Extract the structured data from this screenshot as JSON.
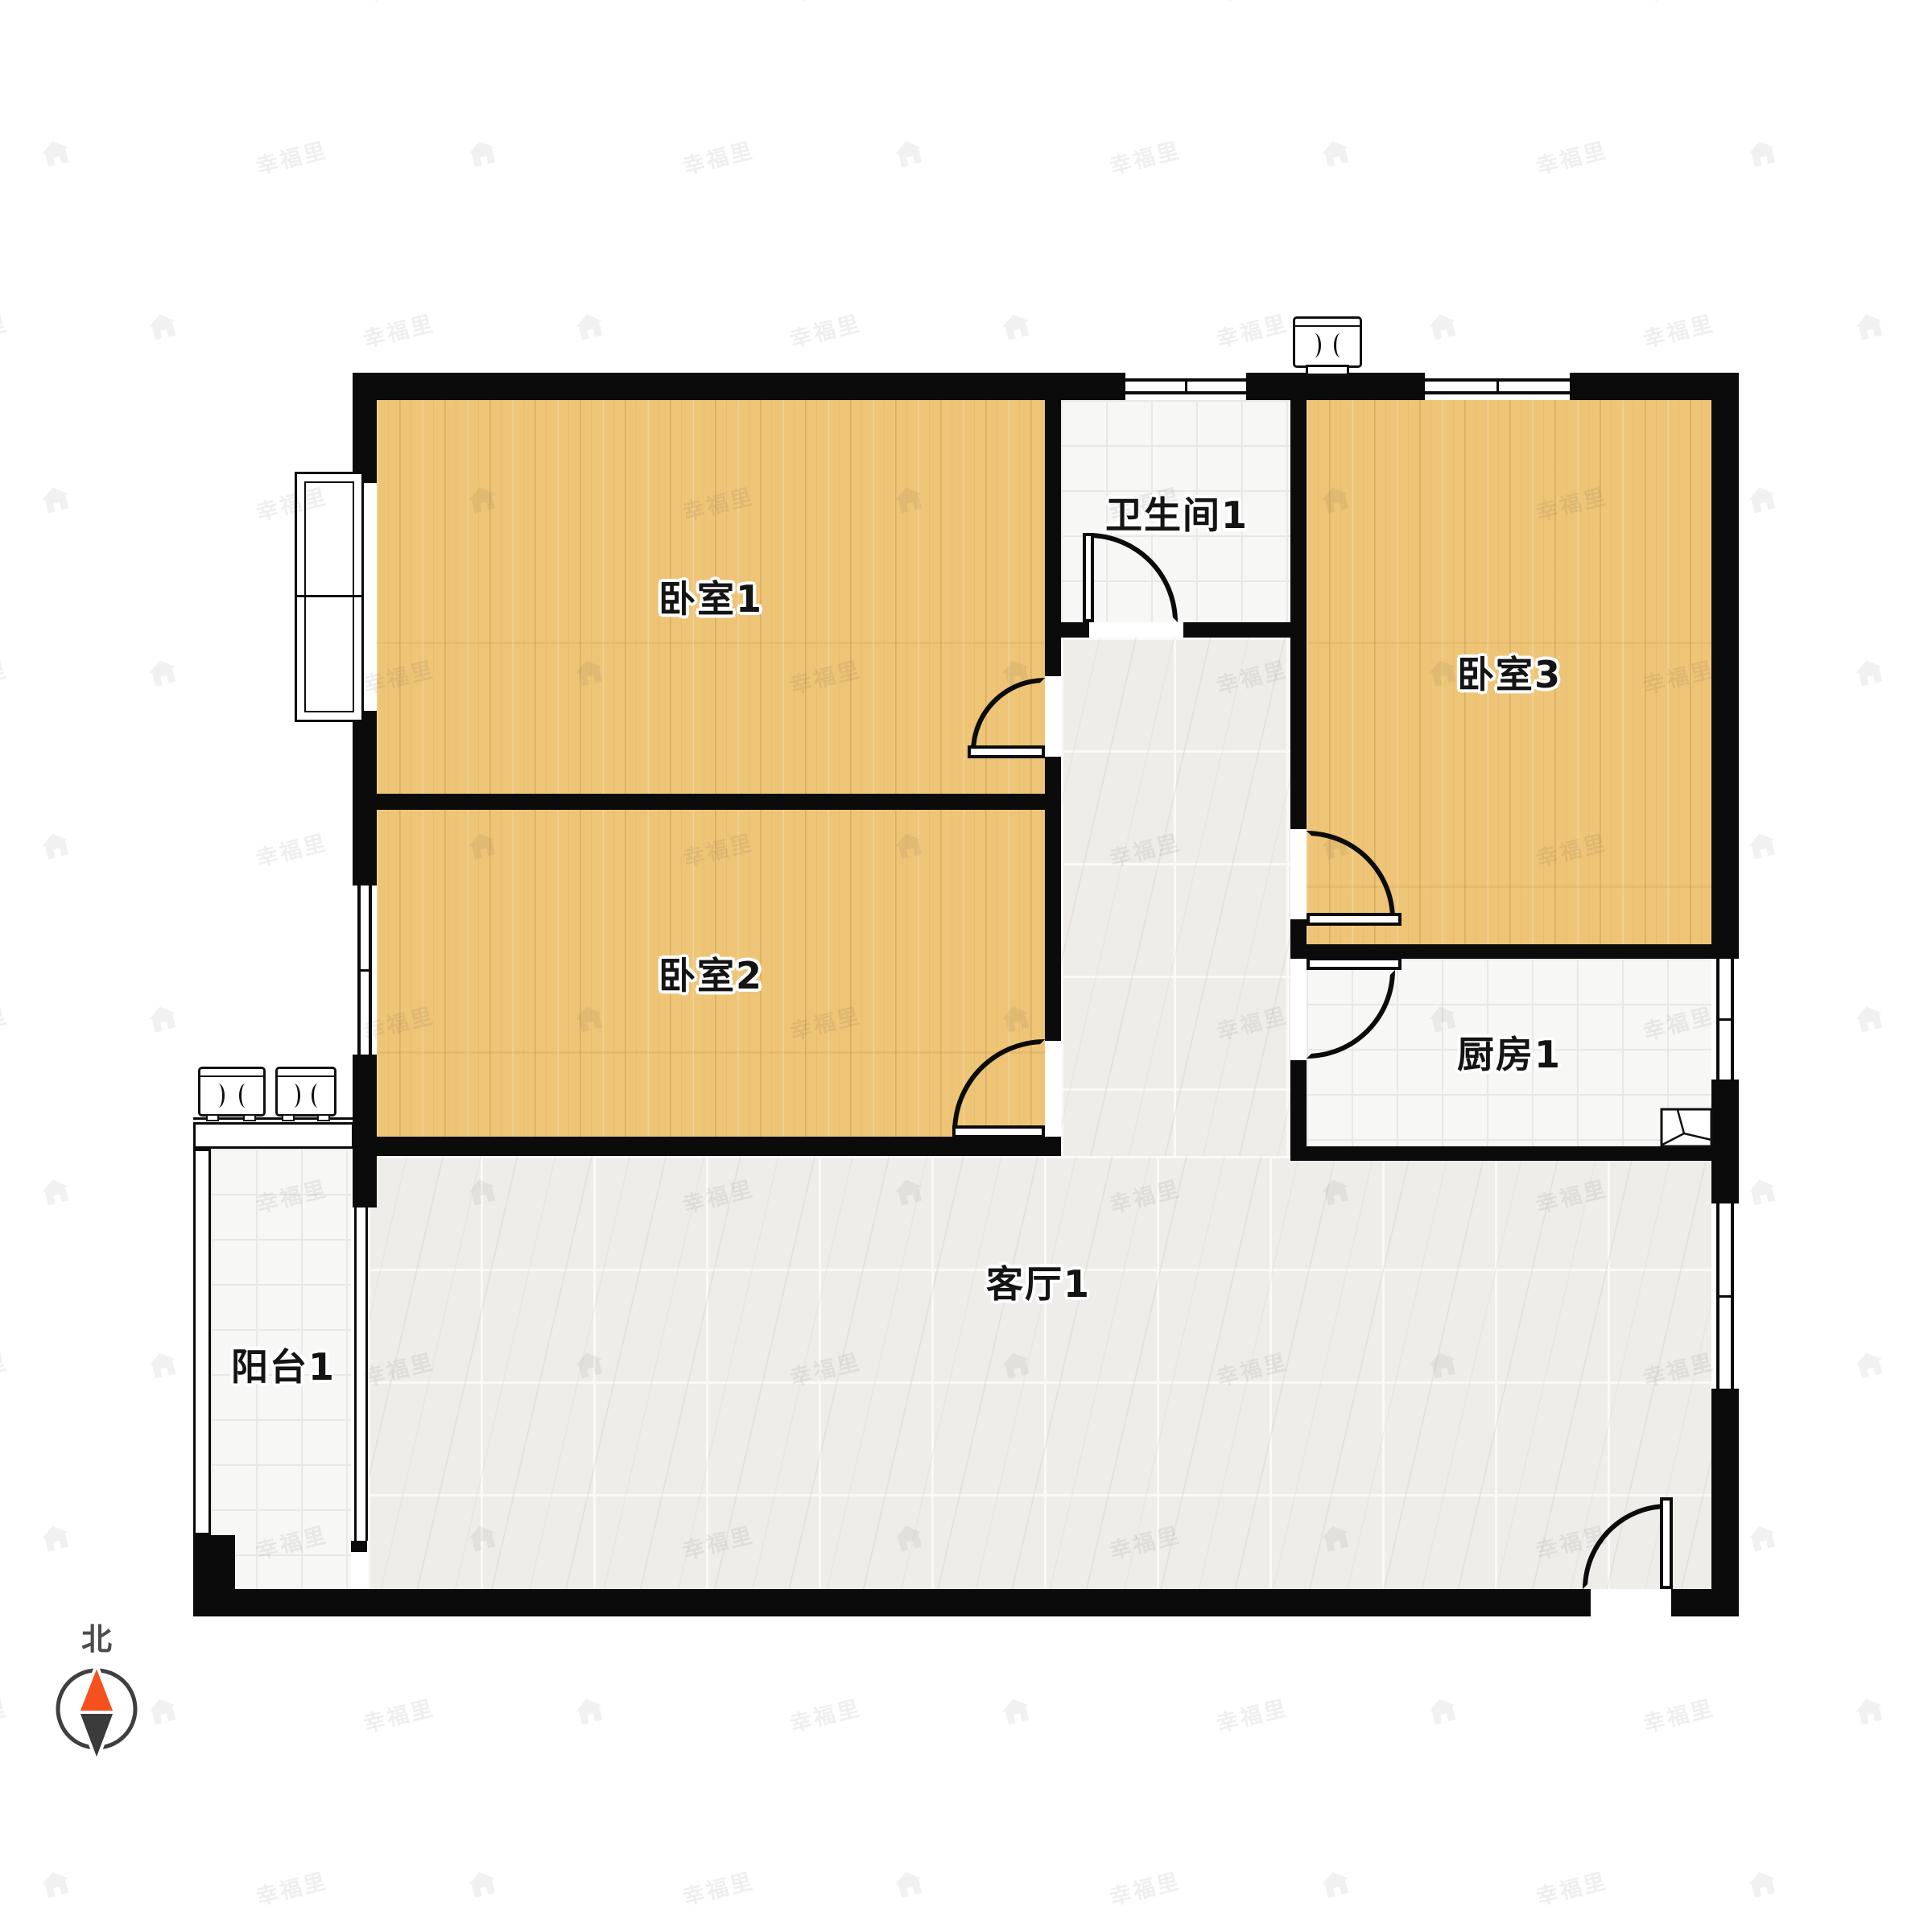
{
  "title": "apartment-floor-plan",
  "rooms": {
    "bedroom1": {
      "label": "卧室1",
      "floor": "wood"
    },
    "bedroom2": {
      "label": "卧室2",
      "floor": "wood"
    },
    "bedroom3": {
      "label": "卧室3",
      "floor": "wood"
    },
    "bathroom1": {
      "label": "卫生间1",
      "floor": "tile"
    },
    "kitchen1": {
      "label": "厨房1",
      "floor": "tile"
    },
    "living1": {
      "label": "客厅1",
      "floor": "marble"
    },
    "balcony1": {
      "label": "阳台1",
      "floor": "tile"
    }
  },
  "compass": {
    "label": "北",
    "needle_up_color": "#f4511e",
    "needle_down_color": "#3b3b3b"
  },
  "watermark": {
    "text": "幸福里",
    "icon": "house-logo-icon"
  },
  "icons": {
    "ac_units": "ac-outdoor-unit-icon",
    "flue": "flue-vent-icon",
    "sink": "kitchen-sink-icon",
    "compass": "compass-needle-icon"
  },
  "colors": {
    "wall": "#0b0b0b",
    "wood_floor": "#eec577",
    "tile_floor": "#f7f7f6",
    "marble_floor": "#efede9",
    "compass_north": "#f4511e",
    "background": "#ffffff"
  }
}
